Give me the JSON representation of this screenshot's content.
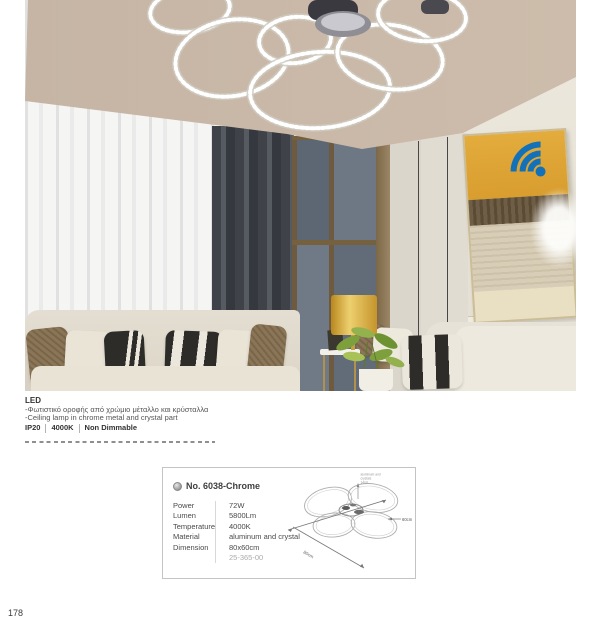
{
  "page": {
    "number": "178"
  },
  "product": {
    "led_label": "LED",
    "description_gr": "-Φωτιστικό οροφής από χρώμιο μέταλλο και κρύσταλλα",
    "description_en": "-Ceiling lamp in chrome metal and crystal part",
    "badges": [
      "IP20",
      "4000K",
      "Non Dimmable"
    ]
  },
  "colors": {
    "wifi_blue": "#1271b8",
    "artwork_yellow": "#e3ac3d",
    "lamp_gold": "#c5942c",
    "ceiling_taupe": "#c6b5a5"
  },
  "spec_box": {
    "model_no": "No. 6038-Chrome",
    "rows": [
      {
        "label": "Power",
        "value": "72W"
      },
      {
        "label": "Lumen",
        "value": "5800Lm"
      },
      {
        "label": "Temperature",
        "value": "4000K"
      },
      {
        "label": "Material",
        "value": "aluminum and crystal"
      },
      {
        "label": "Dimension",
        "value": "80x60cm"
      }
    ],
    "code": "25-365-00",
    "diagram": {
      "width_label": "80cm",
      "depth_label": "60cm",
      "annotation": [
        "aluminum and",
        "crystals",
        "14cm"
      ]
    }
  }
}
